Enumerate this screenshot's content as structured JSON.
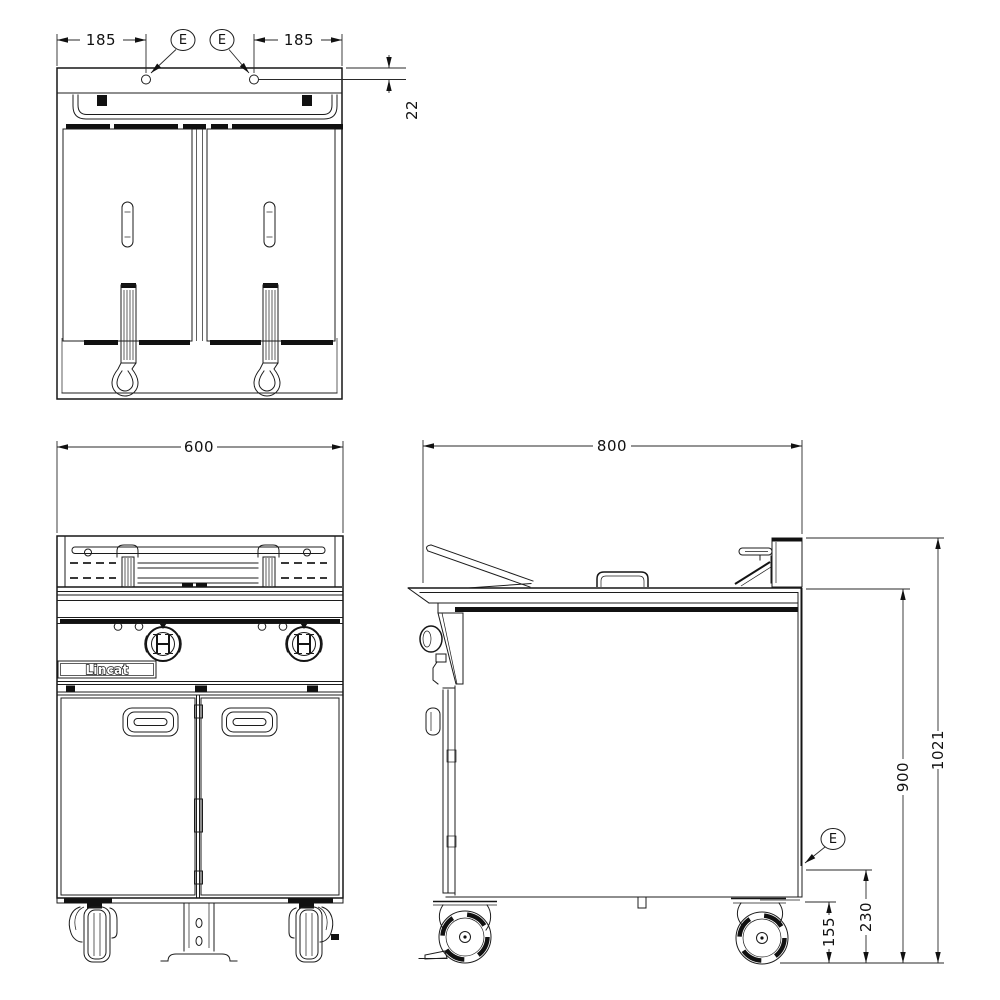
{
  "drawing": {
    "brand": "Lincat",
    "plan": {
      "dim_left": "185",
      "dim_right": "185",
      "dim_offset": "22",
      "callout_a": "E",
      "callout_b": "E"
    },
    "front": {
      "dim_width": "600"
    },
    "side": {
      "dim_depth": "800",
      "dim_height_overall": "1021",
      "dim_height_worktop": "900",
      "dim_height_connection": "230",
      "dim_height_clearance": "155",
      "callout": "E"
    }
  }
}
